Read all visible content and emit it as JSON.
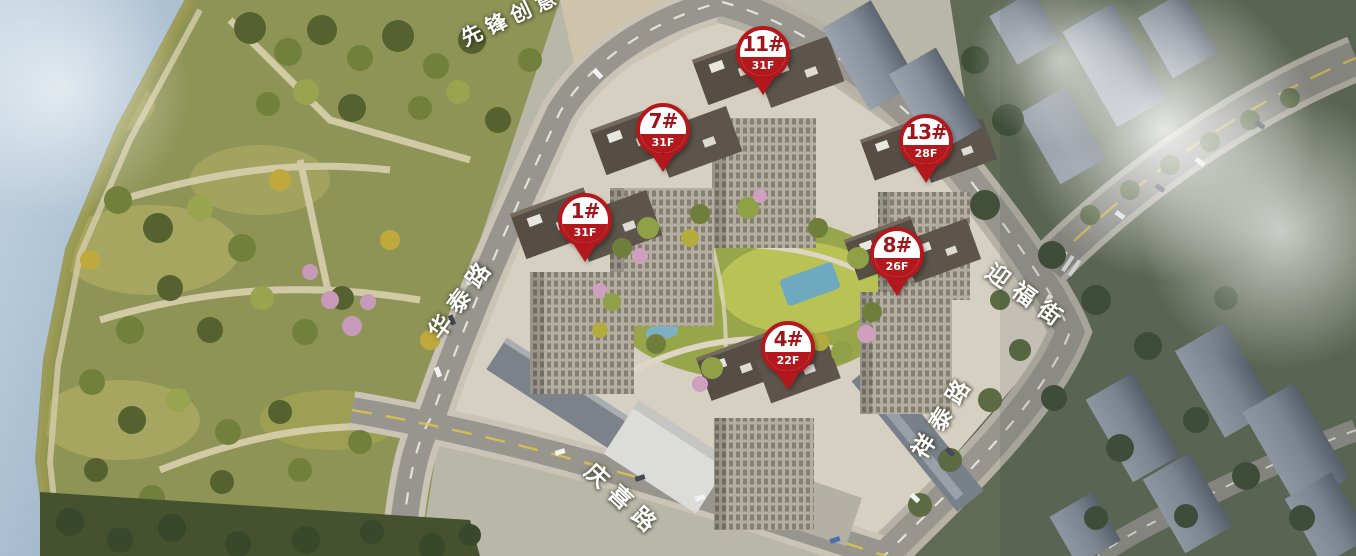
{
  "building_markers": [
    {
      "id": "1#",
      "floors": "31F"
    },
    {
      "id": "4#",
      "floors": "22F"
    },
    {
      "id": "7#",
      "floors": "31F"
    },
    {
      "id": "8#",
      "floors": "26F"
    },
    {
      "id": "11#",
      "floors": "31F"
    },
    {
      "id": "13#",
      "floors": "28F"
    }
  ],
  "road_labels": [
    {
      "name": "先锋创意"
    },
    {
      "name": "华泰路"
    },
    {
      "name": "庆喜路"
    },
    {
      "name": "祥泰路"
    },
    {
      "name": "迎福街"
    }
  ],
  "colors": {
    "marker_red": "#b3181d",
    "marker_number_red": "#9d161b",
    "water_blue": "#a9c0d3",
    "park_green": "#8e9456",
    "road_gray": "#97958d",
    "courtyard_green": "#b9c254"
  }
}
